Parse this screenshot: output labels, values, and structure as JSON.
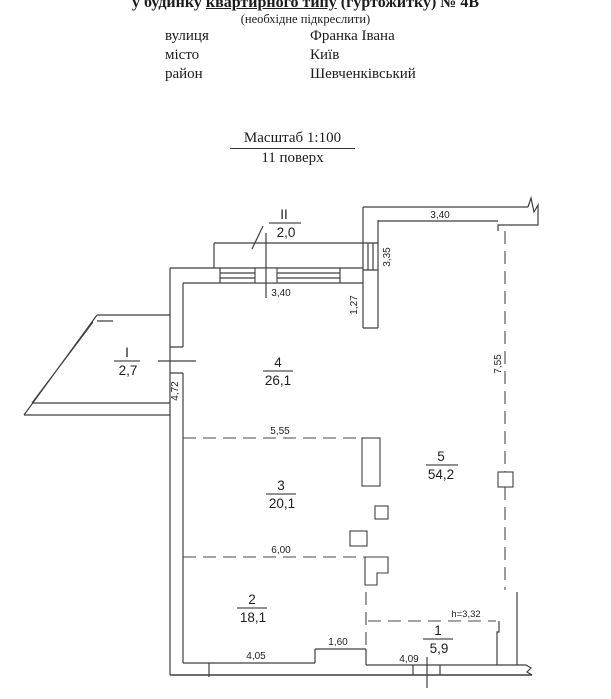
{
  "header": {
    "title": {
      "pre": "у будинку ",
      "underlined": "квартирного типу",
      "post": " (гуртожитку) № 4В"
    },
    "note": "(необхідне підкреслити)",
    "fields": [
      {
        "label": "вулиця",
        "value": "Франка Івана"
      },
      {
        "label": "місто",
        "value": "Київ"
      },
      {
        "label": "район",
        "value": "Шевченківський"
      }
    ]
  },
  "scale_block": {
    "scale": "Масштаб 1:100",
    "floor": "11 поверх"
  },
  "plan": {
    "rooms": [
      {
        "number": "1",
        "area": "5,9"
      },
      {
        "number": "2",
        "area": "18,1"
      },
      {
        "number": "3",
        "area": "20,1"
      },
      {
        "number": "4",
        "area": "26,1"
      },
      {
        "number": "5",
        "area": "54,2"
      }
    ],
    "balconies": [
      {
        "number": "I",
        "area": "2,7"
      },
      {
        "number": "II",
        "area": "2,0"
      }
    ],
    "dimensions": {
      "top_window_width": "3,40",
      "right_window_width": "3,35",
      "pier_below_window": "1,27",
      "room5_top_width": "3,40",
      "room5_right_depth": "7,55",
      "left_wall_depth": "4,72",
      "room34_divider_width": "5,55",
      "room23_divider_width": "6,00",
      "room2_bottom_width": "4,05",
      "bottom_step_width": "1,60",
      "room1_bottom_width": "4,09",
      "ceiling_height": "h=3,32"
    }
  }
}
